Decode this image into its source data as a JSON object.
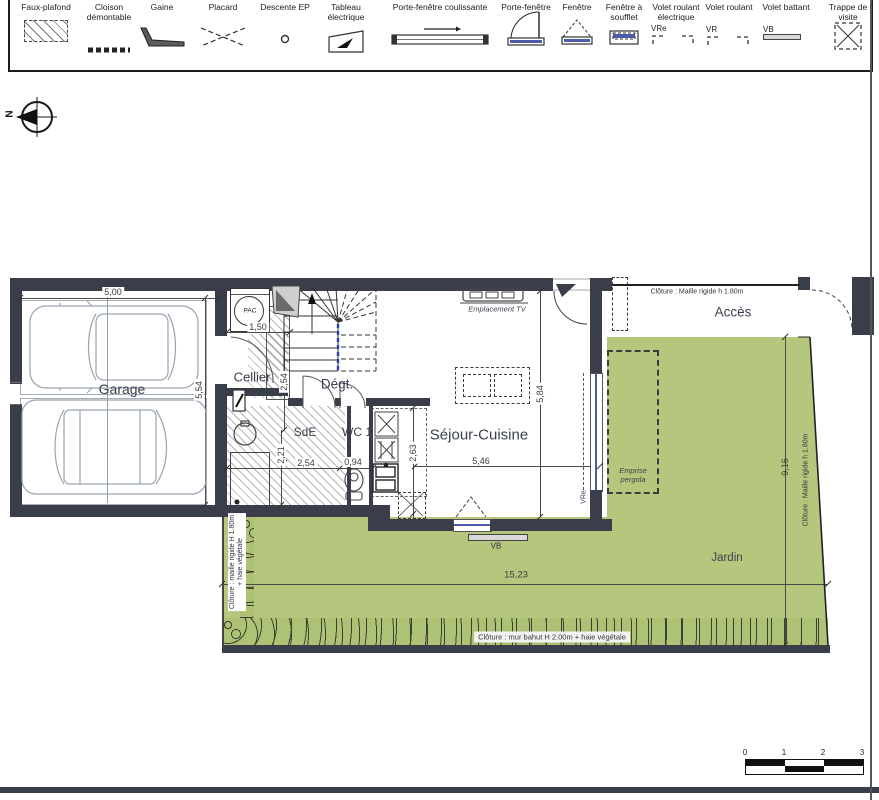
{
  "legend": {
    "items": [
      {
        "label": "Faux-plafond"
      },
      {
        "label": "Cloison démontable"
      },
      {
        "label": "Gaine"
      },
      {
        "label": "Placard"
      },
      {
        "label": "Descente EP"
      },
      {
        "label": "Tableau électrique"
      },
      {
        "label": "Porte-fenêtre coulissante"
      },
      {
        "label": "Porte-fenêtre"
      },
      {
        "label": "Fenêtre"
      },
      {
        "label": "Fenêtre à soufflet"
      },
      {
        "label": "Volet roulant électrique",
        "tag": "VRe"
      },
      {
        "label": "Volet roulant",
        "tag": "VR"
      },
      {
        "label": "Volet battant",
        "tag": "VB"
      },
      {
        "label": "Trappe de visite"
      }
    ]
  },
  "compass": {
    "north": "N"
  },
  "rooms": {
    "garage": "Garage",
    "cellier": "Cellier",
    "degagement": "Dégt.",
    "sde": "SdE",
    "wc": "WC 1",
    "sejour": "Séjour-Cuisine",
    "jardin": "Jardin",
    "acces": "Accès"
  },
  "annotations": {
    "pac": "PAC",
    "tv": "Emplacement TV",
    "pergola_line1": "Emprise",
    "pergola_line2": "pergola",
    "vre": "VRe",
    "vb": "VB",
    "fence_top": "Clôture : Maille rigide h 1.80m",
    "fence_right": "Clôture : Maille rigide h 1.80m",
    "fence_left_line1": "Clôture : maille rigide H 1.80m",
    "fence_left_line2": "+ haie végétale",
    "fence_bottom": "Clôture : mur bahut H 2.00m + haie végétale"
  },
  "dimensions": {
    "garage_w": "5,00",
    "garage_d": "5,54",
    "cellier_w": "1,50",
    "hall_d": "2,54",
    "sde_d": "2,21",
    "sde_w": "2,54",
    "wc_w": "0,94",
    "kitchen_d": "2,63",
    "sejour_w": "5,46",
    "sejour_d": "5,84",
    "jardin_d": "9,16",
    "jardin_w": "15,23"
  },
  "scalebar": {
    "t0": "0",
    "t1": "1",
    "t2": "2",
    "t3": "3"
  },
  "colors": {
    "wall": "#3a3e4b",
    "garden": "#b5c77d",
    "window_blue": "#4d5ca8"
  }
}
